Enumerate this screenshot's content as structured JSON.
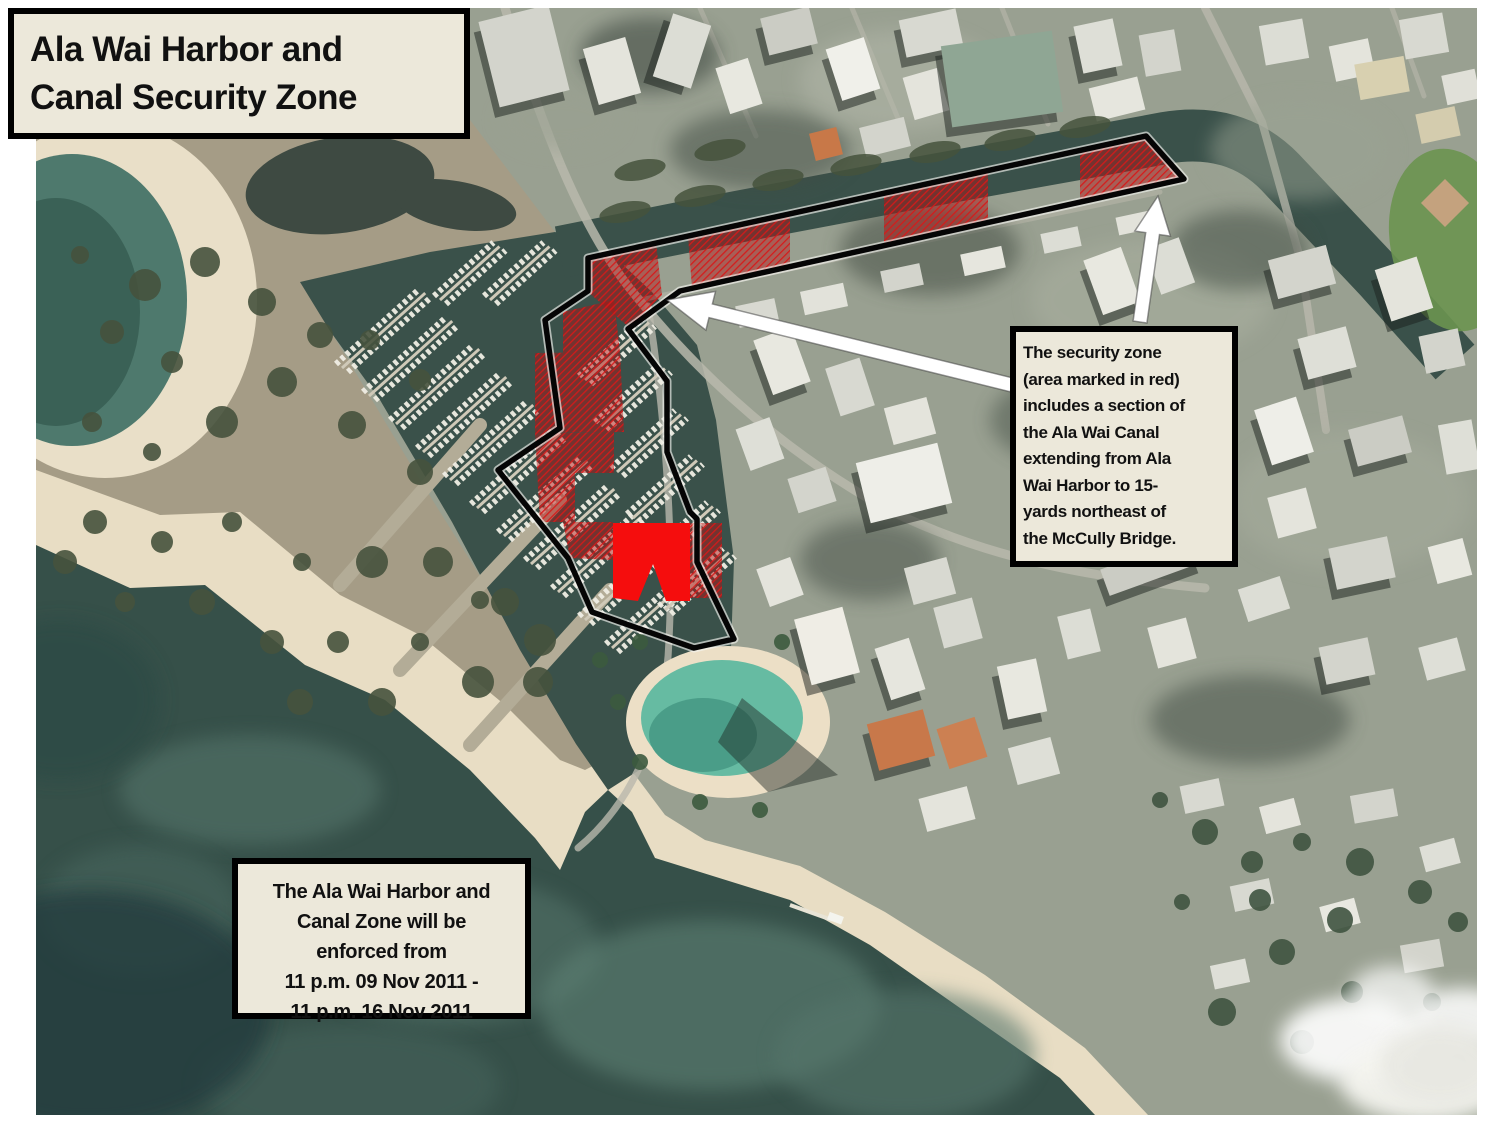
{
  "title_box": {
    "text": "Ala Wai Harbor and\nCanal Security Zone"
  },
  "info_box": {
    "text": "The security zone\n(area marked in red)\nincludes a section of\nthe Ala Wai Canal\nextending from Ala\nWai Harbor to 15-\nyards northeast of\nthe McCully Bridge."
  },
  "enforcement_box": {
    "text": "The Ala Wai Harbor and\nCanal Zone will be\nenforced from\n11 p.m. 09 Nov 2011 -\n11 p.m. 16 Nov 2011"
  },
  "colors": {
    "box_background": "#ece8da",
    "box_border": "#000000",
    "zone_outline": "#050505",
    "zone_red_solid": "#f50d0d",
    "zone_red_hatch": "#c01414",
    "callout_arrow": "#ffffff",
    "ocean_water": "#365049",
    "harbor_water": "#3a514a",
    "lagoon_water": "#66bba2",
    "beach_sand": "#e8ddc4"
  }
}
